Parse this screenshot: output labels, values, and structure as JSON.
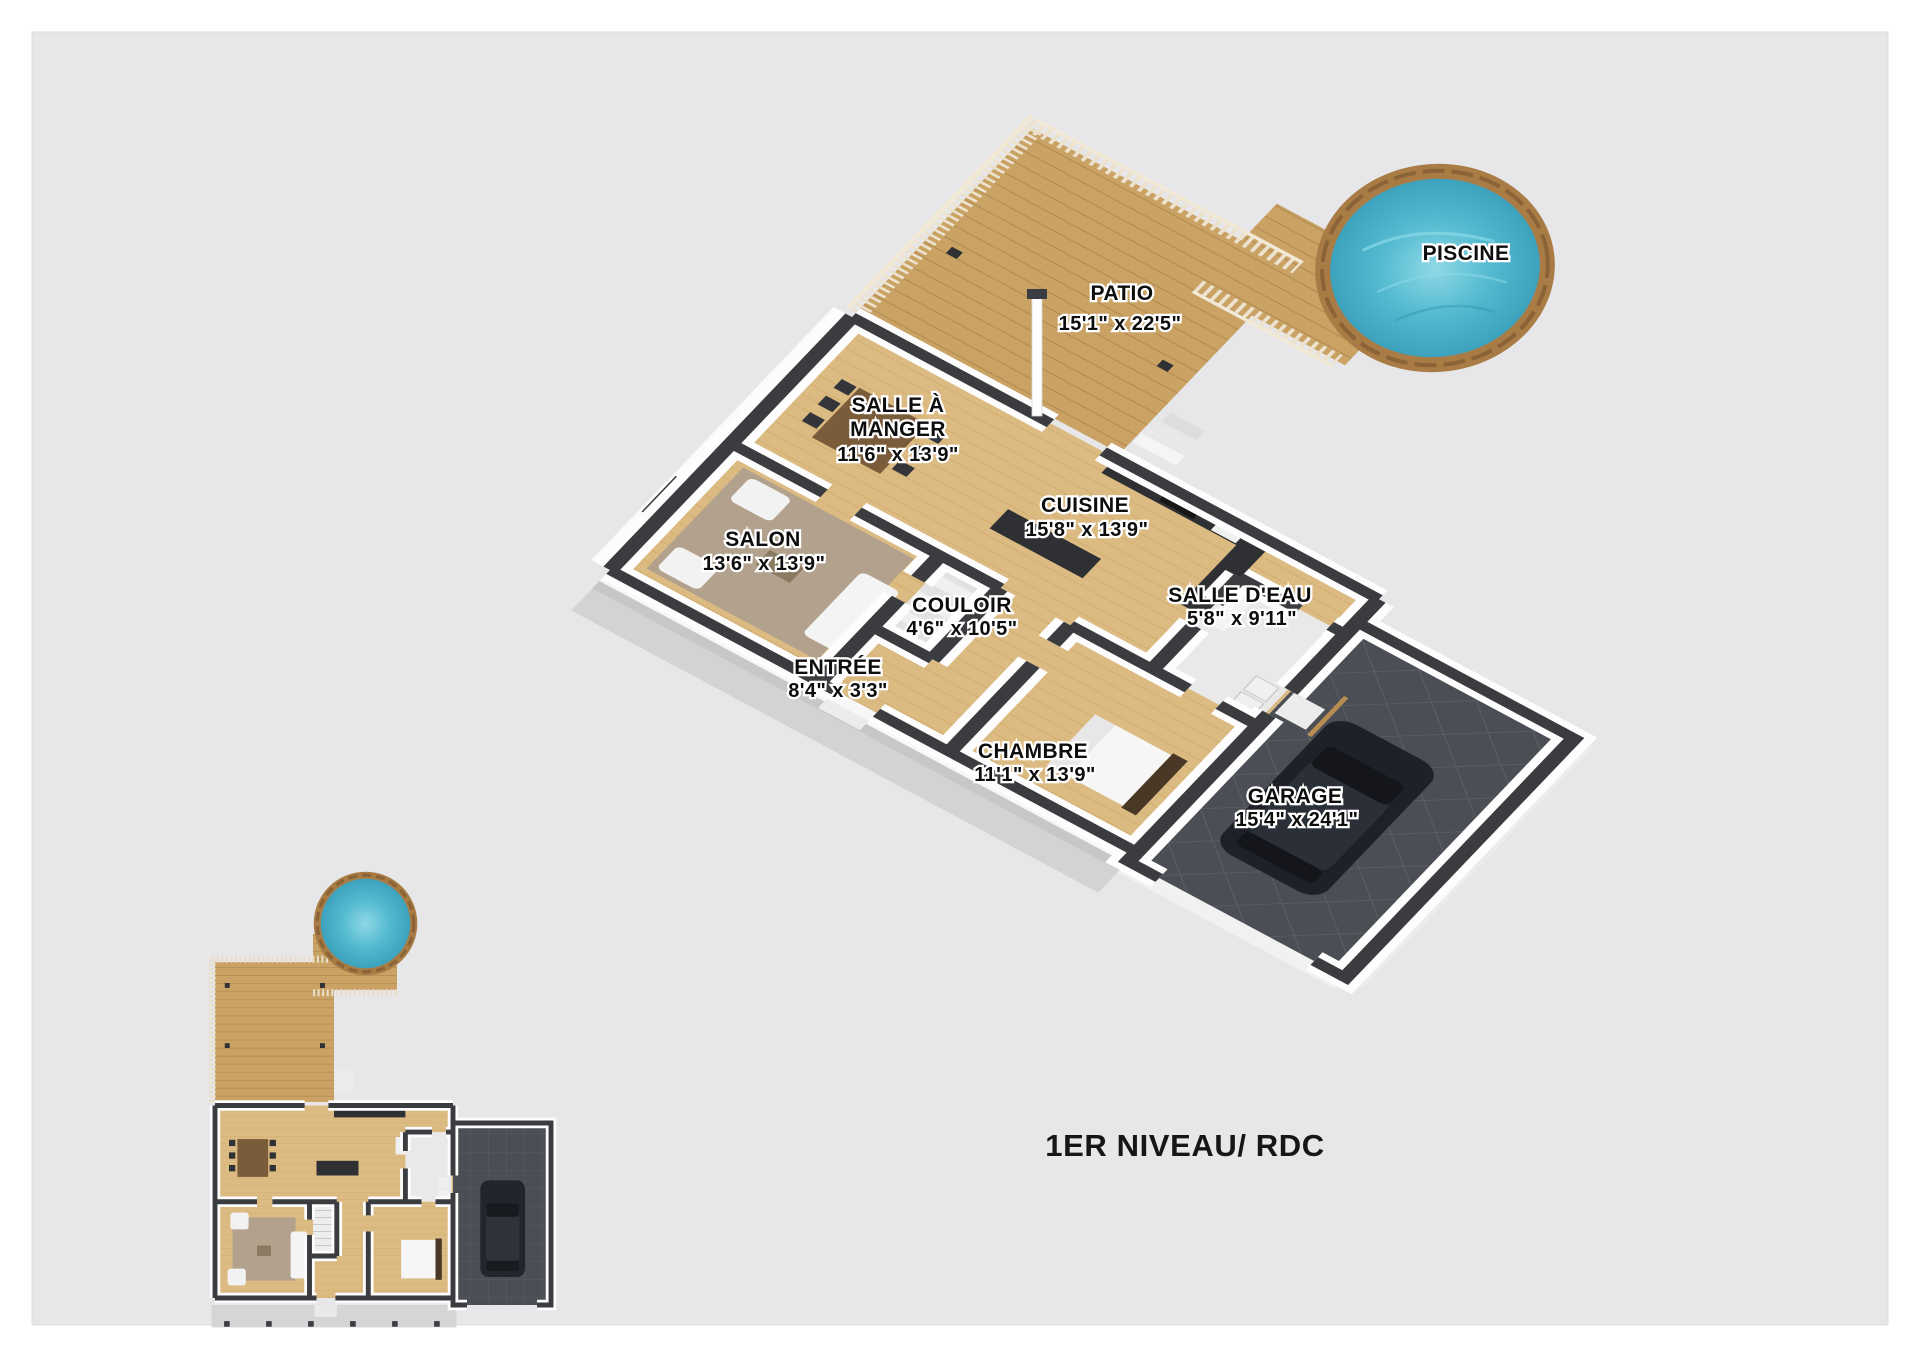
{
  "title": {
    "text": "1ER NIVEAU/ RDC"
  },
  "rooms": {
    "piscine": {
      "label": "PISCINE"
    },
    "patio": {
      "label": "PATIO",
      "dims": "15'1\" x 22'5\""
    },
    "salle_a_manger": {
      "line1": "SALLE À",
      "line2": "MANGER",
      "dims": "11'6\" x 13'9\""
    },
    "cuisine": {
      "label": "CUISINE",
      "dims": "15'8\" x 13'9\""
    },
    "salon": {
      "label": "SALON",
      "dims": "13'6\" x 13'9\""
    },
    "couloir": {
      "label": "COULOIR",
      "dims": "4'6\" x 10'5\""
    },
    "salle_deau": {
      "label": "SALLE D'EAU",
      "dims": "5'8\" x 9'11\""
    },
    "entree": {
      "label": "ENTRÉE",
      "dims": "8'4\" x 3'3\""
    },
    "chambre": {
      "label": "CHAMBRE",
      "dims": "11'1\" x 13'9\""
    },
    "garage": {
      "label": "GARAGE",
      "dims": "15'4\" x 24'1\""
    }
  },
  "colors": {
    "background": "#e7e7e9",
    "page": "#ffffff",
    "wood_floor": "#dcbb83",
    "deck_wood": "#c9a264",
    "pool_water": "#4ab5cd",
    "pool_rim": "#a97c46",
    "garage_floor": "#4b4e54",
    "wall": "#3a3c3f",
    "concrete": "#d2d3d5",
    "label_text": "#0d0d0d",
    "label_halo": "#ffffff"
  }
}
